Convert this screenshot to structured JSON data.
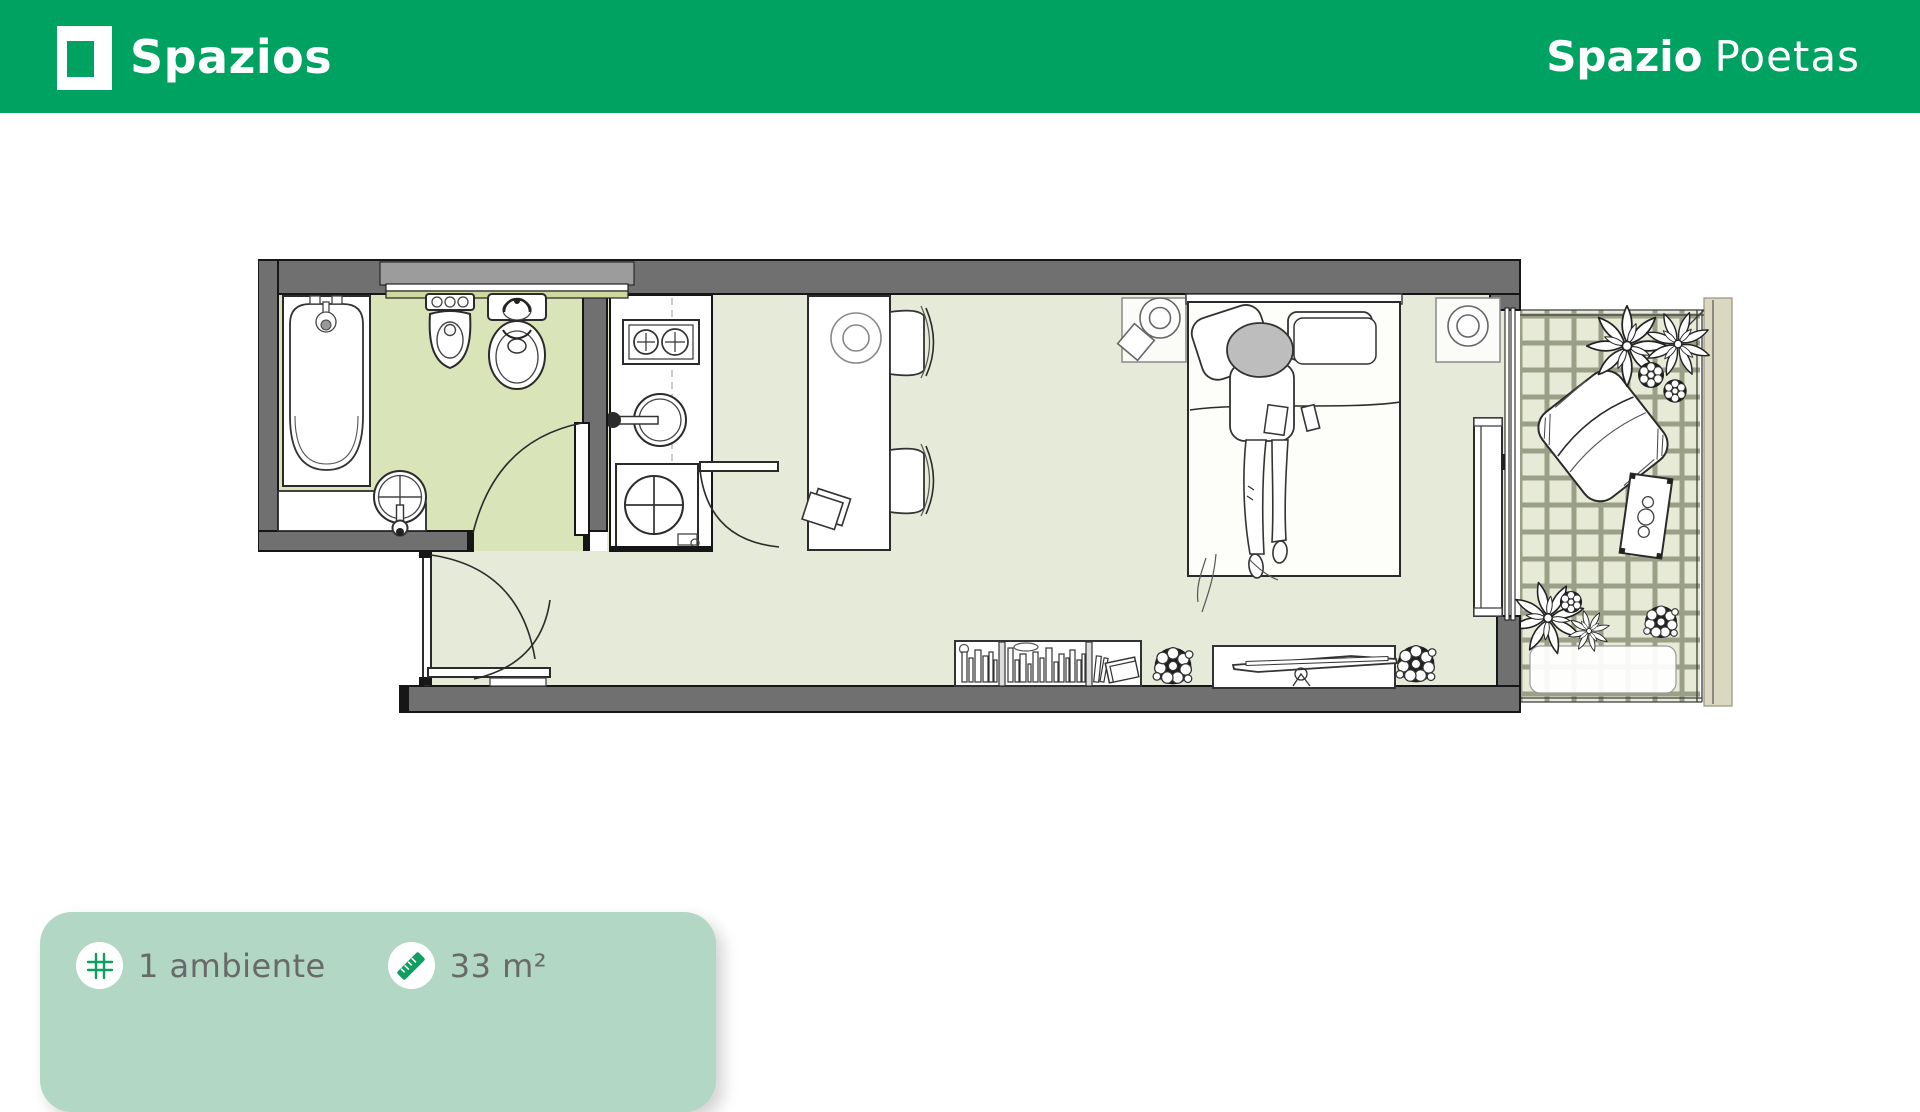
{
  "header": {
    "brand": "Spazios",
    "project": {
      "bold": "Spazio",
      "regular": "Poetas"
    }
  },
  "summary_card": {
    "items": [
      {
        "icon": "grid-icon",
        "label": "1 ambiente"
      },
      {
        "icon": "ruler-icon",
        "label": "33 m²"
      }
    ]
  },
  "floor_plan": {
    "areas": [
      "bathroom",
      "kitchen",
      "main-room",
      "entry-hall",
      "balcony"
    ],
    "fixtures": [
      "bathtub",
      "bathroom-sink",
      "bidet",
      "toilet",
      "stove",
      "kitchen-sink",
      "washing-machine",
      "dining-table",
      "chairs",
      "bed",
      "person-on-bed",
      "nightstands",
      "lamps",
      "wardrobe",
      "bookshelf",
      "tv-console",
      "plants",
      "lounge-chair",
      "balcony-table",
      "balcony-rug"
    ]
  },
  "colors": {
    "header_green": "#00a262",
    "icon_green": "#0d9e60",
    "card_bg": "#b2d7c5",
    "text_gray": "#696969",
    "wall_gray": "#707070",
    "bathroom_floor": "#d9e5b8",
    "room_floor": "#e6ead8",
    "balcony_tile": "#e7ead6",
    "balcony_grout": "#99a087"
  }
}
